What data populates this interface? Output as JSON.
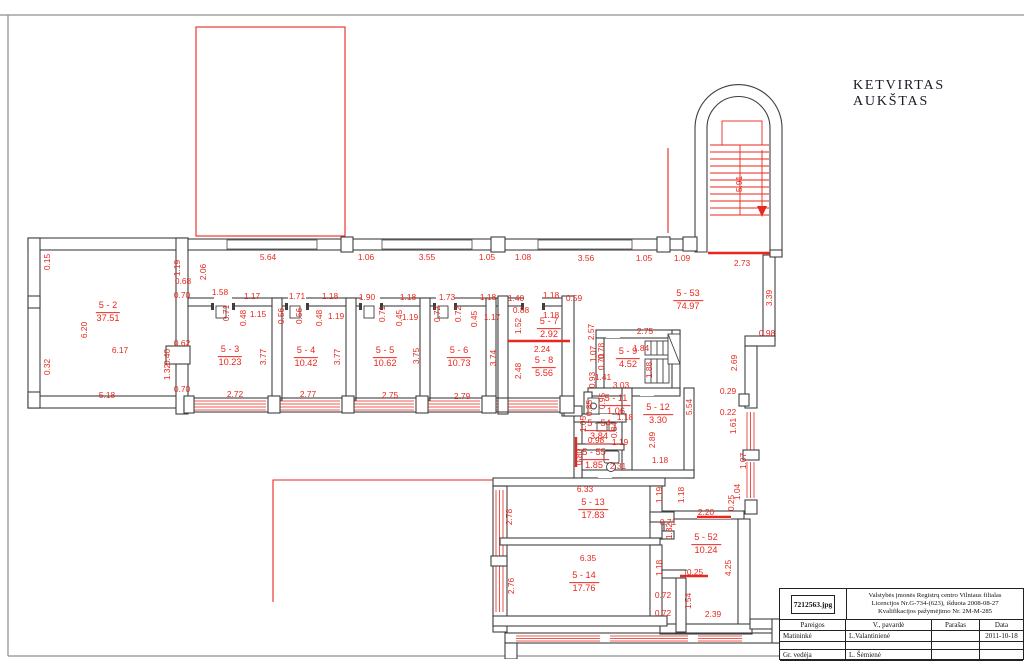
{
  "page": {
    "title": "KETVIRTAS AUKŠTAS"
  },
  "colors": {
    "red": "#e8271e",
    "wall": "#3f3f3f",
    "frame": "#8f8f8f",
    "title_text": "#181824"
  },
  "plan": {
    "rooms": [
      {
        "id": "5 - 2",
        "area": "37.51",
        "x": 108,
        "y": 312
      },
      {
        "id": "5 - 3",
        "area": "10.23",
        "x": 230,
        "y": 356
      },
      {
        "id": "5 - 4",
        "area": "10.42",
        "x": 306,
        "y": 357
      },
      {
        "id": "5 - 5",
        "area": "10.62",
        "x": 385,
        "y": 357
      },
      {
        "id": "5 - 6",
        "area": "10.73",
        "x": 459,
        "y": 357
      },
      {
        "id": "5 - 7",
        "area": "2.92",
        "x": 549,
        "y": 328
      },
      {
        "id": "5 - 8",
        "area": "5.56",
        "x": 544,
        "y": 367
      },
      {
        "id": "5 - 9",
        "area": "4.52",
        "x": 628,
        "y": 358
      },
      {
        "id": "5 - 53",
        "area": "74.97",
        "x": 688,
        "y": 300
      },
      {
        "id": "5 - 11",
        "area": "1.06",
        "x": 616,
        "y": 405
      },
      {
        "id": "5 - 12",
        "area": "3.30",
        "x": 658,
        "y": 414
      },
      {
        "id": "5 - 54",
        "area": "3.84",
        "x": 599,
        "y": 430
      },
      {
        "id": "5 - 55",
        "area": "1.85",
        "x": 594,
        "y": 459
      },
      {
        "id": "5 - 13",
        "area": "17.83",
        "x": 593,
        "y": 509
      },
      {
        "id": "5 - 14",
        "area": "17.76",
        "x": 584,
        "y": 582
      },
      {
        "id": "5 - 52",
        "area": "10.24",
        "x": 706,
        "y": 544
      }
    ],
    "dims": [
      {
        "t": "5.64",
        "x": 268,
        "y": 257
      },
      {
        "t": "1.06",
        "x": 366,
        "y": 257
      },
      {
        "t": "3.55",
        "x": 427,
        "y": 257
      },
      {
        "t": "1.05",
        "x": 487,
        "y": 257
      },
      {
        "t": "1.08",
        "x": 523,
        "y": 257
      },
      {
        "t": "3.56",
        "x": 586,
        "y": 258
      },
      {
        "t": "1.05",
        "x": 644,
        "y": 258
      },
      {
        "t": "1.09",
        "x": 682,
        "y": 258
      },
      {
        "t": "2.73",
        "x": 742,
        "y": 263
      },
      {
        "t": "0.15",
        "x": 47,
        "y": 262,
        "v": 1
      },
      {
        "t": "6.20",
        "x": 84,
        "y": 330,
        "v": 1
      },
      {
        "t": "0.32",
        "x": 47,
        "y": 367,
        "v": 1
      },
      {
        "t": "6.17",
        "x": 120,
        "y": 350
      },
      {
        "t": "5.18",
        "x": 107,
        "y": 395
      },
      {
        "t": "1.19",
        "x": 177,
        "y": 268,
        "v": 1
      },
      {
        "t": "0.68",
        "x": 183,
        "y": 281
      },
      {
        "t": "2.06",
        "x": 203,
        "y": 272,
        "v": 1
      },
      {
        "t": "0.70",
        "x": 182,
        "y": 295
      },
      {
        "t": "1.58",
        "x": 220,
        "y": 292
      },
      {
        "t": "0.62",
        "x": 182,
        "y": 343
      },
      {
        "t": "0.40",
        "x": 167,
        "y": 357,
        "v": 1
      },
      {
        "t": "1.32",
        "x": 167,
        "y": 372,
        "v": 1
      },
      {
        "t": "0.70",
        "x": 182,
        "y": 389
      },
      {
        "t": "1.17",
        "x": 252,
        "y": 296
      },
      {
        "t": "1.71",
        "x": 297,
        "y": 296
      },
      {
        "t": "1.18",
        "x": 330,
        "y": 296
      },
      {
        "t": "1.90",
        "x": 367,
        "y": 297
      },
      {
        "t": "1.18",
        "x": 408,
        "y": 297
      },
      {
        "t": "1.73",
        "x": 447,
        "y": 297
      },
      {
        "t": "1.18",
        "x": 488,
        "y": 297
      },
      {
        "t": "1.40",
        "x": 516,
        "y": 298
      },
      {
        "t": "1.18",
        "x": 551,
        "y": 295
      },
      {
        "t": "0.59",
        "x": 574,
        "y": 298
      },
      {
        "t": "0.71",
        "x": 226,
        "y": 313,
        "v": 1
      },
      {
        "t": "0.48",
        "x": 243,
        "y": 318,
        "v": 1
      },
      {
        "t": "1.15",
        "x": 258,
        "y": 314
      },
      {
        "t": "0.56",
        "x": 281,
        "y": 316,
        "v": 1
      },
      {
        "t": "0.56",
        "x": 299,
        "y": 316,
        "v": 1
      },
      {
        "t": "0.48",
        "x": 319,
        "y": 318,
        "v": 1
      },
      {
        "t": "1.19",
        "x": 336,
        "y": 316
      },
      {
        "t": "0.71",
        "x": 382,
        "y": 314,
        "v": 1
      },
      {
        "t": "0.45",
        "x": 399,
        "y": 318,
        "v": 1
      },
      {
        "t": "1.19",
        "x": 410,
        "y": 317
      },
      {
        "t": "0.72",
        "x": 437,
        "y": 314,
        "v": 1
      },
      {
        "t": "0.72",
        "x": 458,
        "y": 314,
        "v": 1
      },
      {
        "t": "0.45",
        "x": 474,
        "y": 319,
        "v": 1
      },
      {
        "t": "1.17",
        "x": 492,
        "y": 317
      },
      {
        "t": "0.88",
        "x": 521,
        "y": 310
      },
      {
        "t": "1.52",
        "x": 518,
        "y": 326,
        "v": 1
      },
      {
        "t": "1.18",
        "x": 551,
        "y": 315
      },
      {
        "t": "3.77",
        "x": 263,
        "y": 357,
        "v": 1
      },
      {
        "t": "2.72",
        "x": 235,
        "y": 394
      },
      {
        "t": "3.77",
        "x": 337,
        "y": 357,
        "v": 1
      },
      {
        "t": "2.77",
        "x": 308,
        "y": 394
      },
      {
        "t": "3.75",
        "x": 416,
        "y": 356,
        "v": 1
      },
      {
        "t": "2.75",
        "x": 390,
        "y": 395
      },
      {
        "t": "3.74",
        "x": 493,
        "y": 358,
        "v": 1
      },
      {
        "t": "2.79",
        "x": 462,
        "y": 396
      },
      {
        "t": "2.57",
        "x": 591,
        "y": 332,
        "v": 1
      },
      {
        "t": "2.24",
        "x": 542,
        "y": 349
      },
      {
        "t": "2.48",
        "x": 518,
        "y": 371,
        "v": 1
      },
      {
        "t": "2.75",
        "x": 645,
        "y": 331
      },
      {
        "t": "1.84",
        "x": 641,
        "y": 348
      },
      {
        "t": "1.88",
        "x": 649,
        "y": 370,
        "v": 1
      },
      {
        "t": "1.07",
        "x": 593,
        "y": 354,
        "v": 1
      },
      {
        "t": "0.78",
        "x": 601,
        "y": 351,
        "v": 1
      },
      {
        "t": "0.70",
        "x": 601,
        "y": 362,
        "v": 1
      },
      {
        "t": "1.41",
        "x": 603,
        "y": 377
      },
      {
        "t": "0.93",
        "x": 592,
        "y": 380,
        "v": 1
      },
      {
        "t": "3.03",
        "x": 621,
        "y": 385
      },
      {
        "t": "3.39",
        "x": 769,
        "y": 298,
        "v": 1
      },
      {
        "t": "0.98",
        "x": 767,
        "y": 333
      },
      {
        "t": "2.69",
        "x": 734,
        "y": 363,
        "v": 1
      },
      {
        "t": "0.29",
        "x": 728,
        "y": 391
      },
      {
        "t": "0.22",
        "x": 728,
        "y": 412
      },
      {
        "t": "1.61",
        "x": 733,
        "y": 426,
        "v": 1
      },
      {
        "t": "5.54",
        "x": 689,
        "y": 407,
        "v": 1
      },
      {
        "t": "1.07",
        "x": 743,
        "y": 461,
        "v": 1
      },
      {
        "t": "1.04",
        "x": 737,
        "y": 492,
        "v": 1
      },
      {
        "t": "0.95",
        "x": 602,
        "y": 401,
        "v": 1
      },
      {
        "t": "0.85",
        "x": 589,
        "y": 408,
        "v": 1
      },
      {
        "t": "1.18",
        "x": 625,
        "y": 417
      },
      {
        "t": "2.89",
        "x": 652,
        "y": 440,
        "v": 1
      },
      {
        "t": "1.18",
        "x": 660,
        "y": 460
      },
      {
        "t": "1.05",
        "x": 583,
        "y": 424,
        "v": 1
      },
      {
        "t": "0.84",
        "x": 614,
        "y": 430,
        "v": 1
      },
      {
        "t": "0.98",
        "x": 596,
        "y": 440
      },
      {
        "t": "1.19",
        "x": 620,
        "y": 442
      },
      {
        "t": "0.80",
        "x": 579,
        "y": 457,
        "v": 1
      },
      {
        "t": "2.31",
        "x": 618,
        "y": 466
      },
      {
        "t": "6.33",
        "x": 585,
        "y": 489
      },
      {
        "t": "1.19",
        "x": 659,
        "y": 495,
        "v": 1
      },
      {
        "t": "1.18",
        "x": 681,
        "y": 495,
        "v": 1
      },
      {
        "t": "2.78",
        "x": 509,
        "y": 517,
        "v": 1
      },
      {
        "t": "0.71",
        "x": 668,
        "y": 522
      },
      {
        "t": "1.32",
        "x": 669,
        "y": 531,
        "v": 1
      },
      {
        "t": "2.20",
        "x": 706,
        "y": 512
      },
      {
        "t": "0.25",
        "x": 731,
        "y": 503,
        "v": 1
      },
      {
        "t": "6.35",
        "x": 588,
        "y": 558
      },
      {
        "t": "2.76",
        "x": 511,
        "y": 586,
        "v": 1
      },
      {
        "t": "1.18",
        "x": 659,
        "y": 568,
        "v": 1
      },
      {
        "t": "0.25",
        "x": 695,
        "y": 572
      },
      {
        "t": "4.25",
        "x": 728,
        "y": 568,
        "v": 1
      },
      {
        "t": "0.72",
        "x": 663,
        "y": 595
      },
      {
        "t": "1.54",
        "x": 688,
        "y": 601,
        "v": 1
      },
      {
        "t": "0.72",
        "x": 663,
        "y": 613
      },
      {
        "t": "2.39",
        "x": 713,
        "y": 614
      },
      {
        "t": "5.91",
        "x": 739,
        "y": 184,
        "v": 1
      }
    ]
  },
  "title_block": {
    "file_label": "7212563.jpg",
    "org_lines": [
      "Valstybės įmonės Registrų centro  Vilniaus filialas",
      "Licencijos Nr.G-734-(623), išduota 2008-08-27",
      "Kvalifikacijos pažymėjimo Nr. 2M-M-285"
    ],
    "columns": [
      "Pareigos",
      "V., pavardė",
      "Parašas",
      "Data"
    ],
    "rows": [
      [
        "Matininkė",
        "L.Valantinienė",
        "",
        "2011-10-18"
      ],
      [
        "",
        "",
        "",
        ""
      ],
      [
        "Gr. vedėja",
        "L. Šėmienė",
        "",
        ""
      ]
    ]
  }
}
